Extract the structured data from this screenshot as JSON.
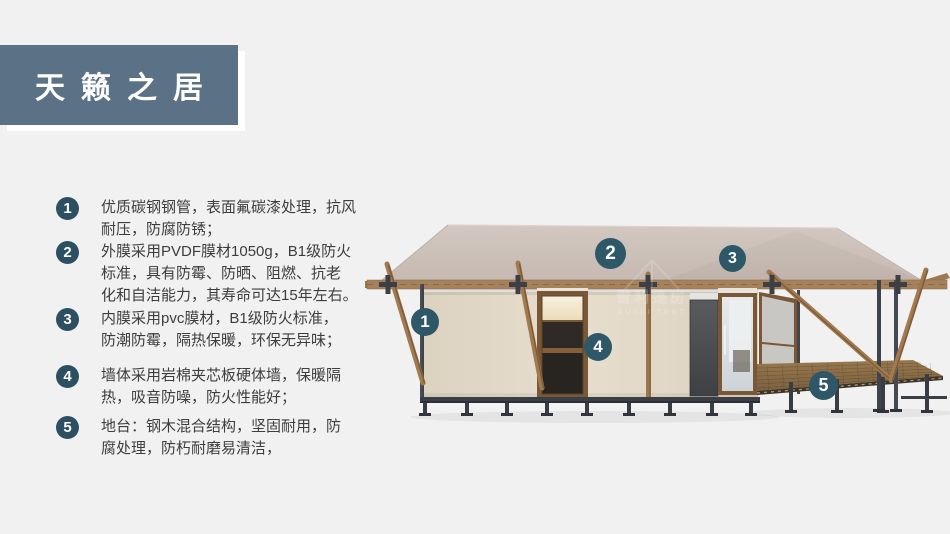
{
  "title": "天籁之居",
  "features": [
    {
      "num": "1",
      "lines": [
        "优质碳钢钢管，表面氟碳漆处理，抗风",
        "耐压，防腐防锈；"
      ]
    },
    {
      "num": "2",
      "lines": [
        "外膜采用PVDF膜材1050g，B1级防火",
        "标准，具有防霉、防晒、阻燃、抗老",
        "化和自洁能力，其寿命可达15年左右。"
      ]
    },
    {
      "num": "3",
      "lines": [
        "内膜采用pvc膜材，B1级防火标准，",
        "防潮防霉，隔热保暖，环保无异味；"
      ]
    },
    {
      "num": "4",
      "lines": [
        "墙体采用岩棉夹芯板硬体墙，保暖隔",
        "热，吸音防噪，防火性能好；"
      ]
    },
    {
      "num": "5",
      "lines": [
        "地台：钢木混合结构，坚固耐用，防",
        "腐处理，防朽耐磨易清洁，"
      ]
    }
  ],
  "diagram": {
    "badges": [
      {
        "num": "1"
      },
      {
        "num": "2"
      },
      {
        "num": "3"
      },
      {
        "num": "4"
      },
      {
        "num": "5"
      }
    ],
    "watermark": {
      "cn": "雪利篷房",
      "en": "XUELI TENT"
    }
  },
  "colors": {
    "page_bg": "#f1f1f2",
    "header_bg": "#5a7186",
    "badge_bg": "#2e5767",
    "list_circle_bg": "#2d4f62",
    "text": "#3d3d3d",
    "roof": "#ccc1b9",
    "wall": "#e0d7c5",
    "wood": "#a1794f",
    "steel": "#3f444a",
    "deck": "#8a6e4b"
  }
}
